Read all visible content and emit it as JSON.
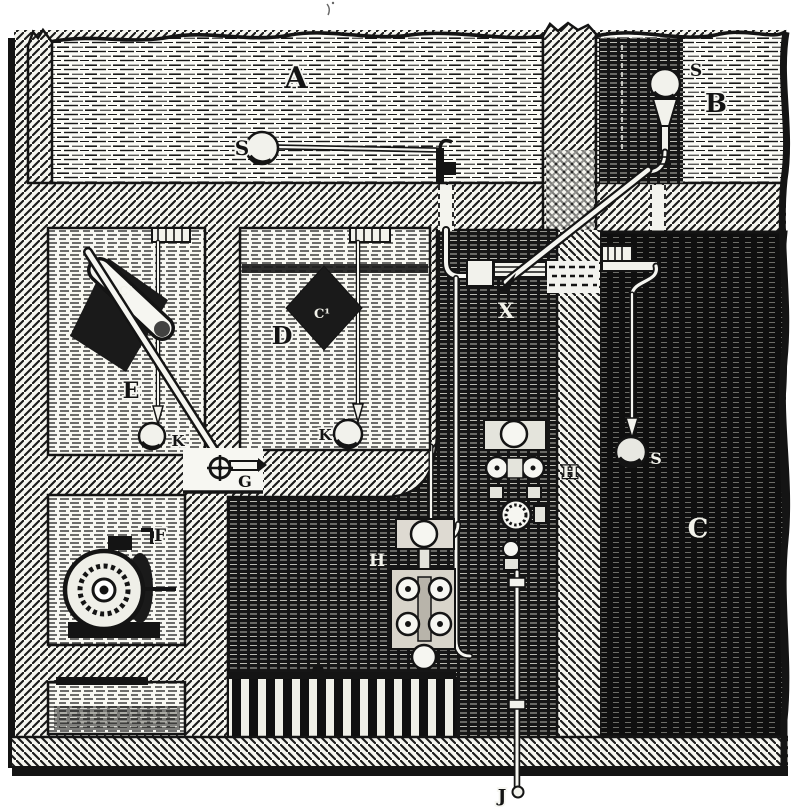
{
  "figure": {
    "title": "Sectional engraving of a building water-supply and drainage system",
    "ink_color": "#141414",
    "paper_color": "#ffffff"
  },
  "labels": {
    "A": "A",
    "B": "B",
    "C": "C",
    "D": "D",
    "E": "E",
    "F": "F",
    "G": "G",
    "H_machine": "H",
    "H_shaft": "H",
    "J": "J",
    "K_e": "K",
    "K_d": "K",
    "S_a": "S",
    "S_b": "S",
    "S_c": "S",
    "X": "X",
    "C1_e": "C¹",
    "C1_d": "C¹"
  }
}
